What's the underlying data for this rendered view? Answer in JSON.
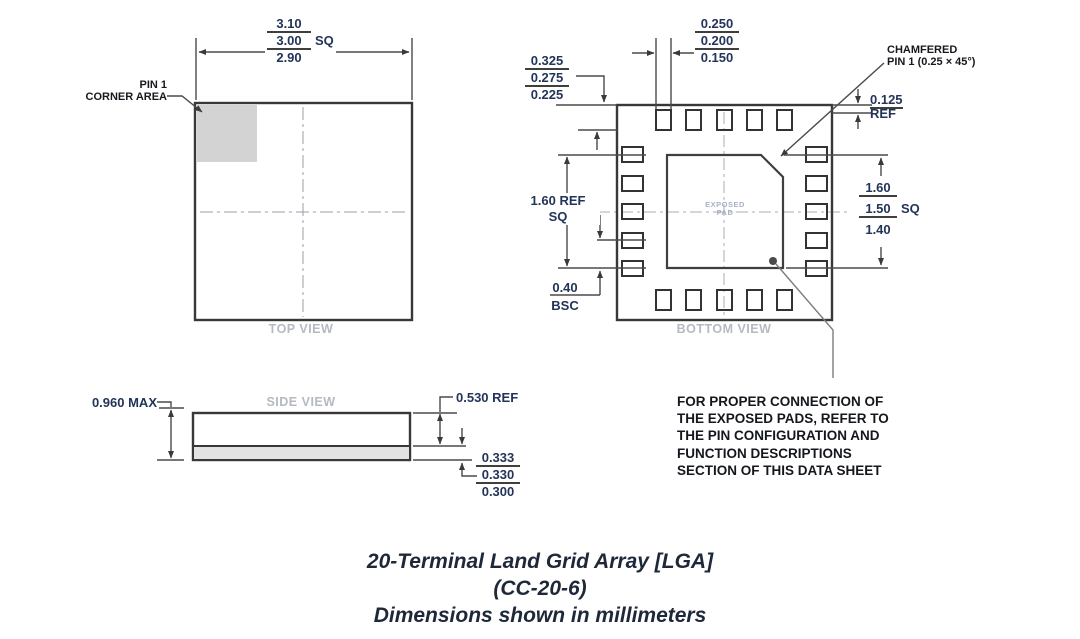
{
  "top_view": {
    "label": "TOP VIEW",
    "pin1_label_line1": "PIN 1",
    "pin1_label_line2": "CORNER AREA",
    "dim_width": {
      "max": "3.10",
      "nom": "3.00",
      "suffix": "SQ",
      "min": "2.90"
    }
  },
  "bottom_view": {
    "label": "BOTTOM VIEW",
    "exposed_pad_line1": "EXPOSED",
    "exposed_pad_line2": "PAD",
    "chamfer_note_line1": "CHAMFERED",
    "chamfer_note_line2": "PIN 1 (0.25 × 45°)",
    "dim_pad_width": {
      "max": "0.250",
      "nom": "0.200",
      "min": "0.150"
    },
    "dim_pad_length": {
      "max": "0.325",
      "nom": "0.275",
      "min": "0.225"
    },
    "dim_pad_span_line1": "1.60 REF",
    "dim_pad_span_line2": "SQ",
    "dim_pitch_value": "0.40",
    "dim_pitch_qualifier": "BSC",
    "dim_exposed_pad": {
      "max": "1.60",
      "nom": "1.50",
      "suffix": "SQ",
      "min": "1.40"
    },
    "dim_edge_value": "0.125",
    "dim_edge_qualifier": "REF"
  },
  "side_view": {
    "label": "SIDE VIEW",
    "dim_height": "0.960 MAX",
    "dim_body": "0.530 REF",
    "dim_terminal": {
      "max": "0.333",
      "nom": "0.330",
      "min": "0.300"
    }
  },
  "note": {
    "lines": [
      "FOR PROPER CONNECTION OF",
      "THE EXPOSED PADS, REFER TO",
      "THE PIN CONFIGURATION AND",
      "FUNCTION DESCRIPTIONS",
      "SECTION OF THIS DATA SHEET"
    ]
  },
  "caption": {
    "line1": "20-Terminal Land Grid Array [LGA]",
    "line2": "(CC-20-6)",
    "line3": "Dimensions shown in millimeters"
  },
  "colors": {
    "dimension_text": "#233459",
    "annotation_text": "#16181d",
    "view_label_text": "#b4b9c2",
    "drawing_line": "#4a4a4a",
    "pin1_area_fill": "#d3d3d3",
    "terminal_strip_fill": "#e3e3e3"
  }
}
